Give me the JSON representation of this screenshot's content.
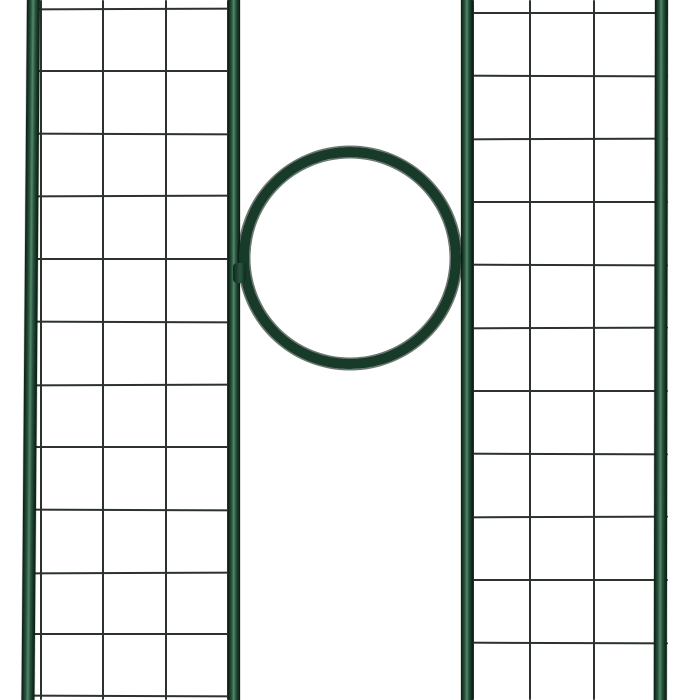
{
  "scene": {
    "subject": "dark-green metal garden trellis arch section: two wire-mesh side panels joined by a central circular ring",
    "canvas": {
      "width": 700,
      "height": 700
    },
    "background": "#ffffff",
    "colors": {
      "wire": "#2b332c",
      "tube_edge": "#0a1d12",
      "tube_dark": "#143122",
      "tube_mid": "#2a5740",
      "tube_highlight": "#55866a",
      "ring": "#173a29",
      "ring_joint": "#0f281b"
    },
    "wire_thickness": 2,
    "panels": [
      {
        "name": "left-mesh-panel",
        "tubes": [
          {
            "x": 27,
            "width": 13,
            "tilt_deg": 0.45
          },
          {
            "x": 228,
            "width": 12,
            "tilt_deg": 0
          }
        ],
        "vertical_wires_x": [
          41,
          103,
          166,
          228
        ],
        "horizontal_wires_y": [
          9,
          71,
          134,
          196,
          259,
          322,
          385,
          447,
          510,
          573,
          634,
          696
        ],
        "wire_span": {
          "x1": 30,
          "x2": 238
        }
      },
      {
        "name": "right-mesh-panel",
        "tubes": [
          {
            "x": 461,
            "width": 12,
            "tilt_deg": 0
          },
          {
            "x": 655,
            "width": 13,
            "tilt_deg": 0.1
          }
        ],
        "vertical_wires_x": [
          473,
          530,
          594,
          657
        ],
        "horizontal_wires_y": [
          13,
          76,
          139,
          202,
          265,
          328,
          391,
          454,
          517,
          580,
          643
        ],
        "wire_span": {
          "x1": 463,
          "x2": 668
        }
      }
    ],
    "ring": {
      "cx": 350,
      "cy": 258,
      "outer_radius": 111,
      "tube_thickness": 10,
      "joint": {
        "x": 233,
        "y": 263,
        "width": 13,
        "height": 20
      }
    }
  }
}
